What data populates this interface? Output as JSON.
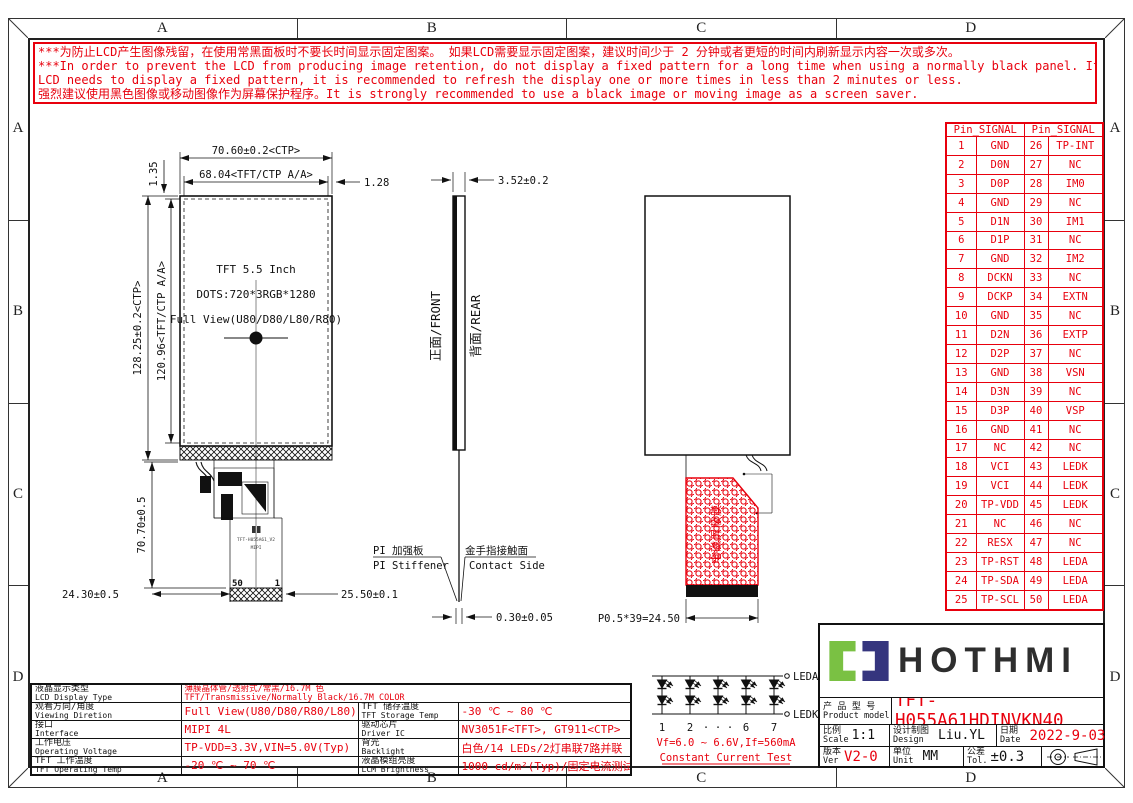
{
  "colors": {
    "red": "#e8000d",
    "logo_green": "#7ac143",
    "logo_navy": "#35357e"
  },
  "border": {
    "zones": [
      "A",
      "B",
      "C",
      "D"
    ]
  },
  "warning": {
    "lines": [
      "***为防止LCD产生图像残留，在使用常黑面板时不要长时间显示固定图案。 如果LCD需要显示固定图案，建议时间少于 2 分钟或者更短的时间内刷新显示内容一次或多次。",
      "***In order to prevent the LCD from producing image retention, do not display a fixed pattern for a long time when using a normally black panel. If the",
      " LCD needs to display a fixed pattern, it is recommended to refresh the display one or more times in less than 2 minutes or less.",
      "强烈建议使用黑色图像或移动图像作为屏幕保护程序。It is strongly recommended to use a black image or moving image as a screen saver."
    ]
  },
  "front_view": {
    "dim_width_ctp": "70.60±0.2<CTP>",
    "dim_width_aa": "68.04<TFT/CTP A/A>",
    "dim_edge_right": "1.28",
    "dim_edge_top": "1.35",
    "dim_height_ctp": "128.25±0.2<CTP>",
    "dim_height_aa": "120.96<TFT/CTP A/A>",
    "panel_line1": "TFT 5.5 Inch",
    "panel_line2": "DOTS:720*3RGB*1280",
    "panel_line3": "Full View(U80/D80/L80/R80)",
    "dim_fpc_length": "70.70±0.5",
    "dim_bottom_left": "24.30±0.5",
    "dim_connector": "25.50±0.1",
    "pin_label_50": "50",
    "pin_label_1": "1",
    "fpc_text_model": "TFT-H055A61_V2",
    "fpc_text_mipi": "MIPI"
  },
  "side_view": {
    "dim_thickness": "3.52±0.2",
    "label_front": "正面/FRONT",
    "label_rear": "背面/REAR",
    "stiffener_cn": "PI 加强板",
    "stiffener_en": "PI Stiffener",
    "contact_cn": "金手指接触面",
    "contact_en": "Contact Side",
    "dim_fpc_thickness": "0.30±0.05"
  },
  "rear_view": {
    "shield_film_label": "电磁屏蔽膜",
    "dim_pin_pitch": "P0.5*39=24.50"
  },
  "pin_table": {
    "header_left": "Pin_SIGNAL",
    "header_right": "Pin_SIGNAL",
    "rows": [
      [
        "1",
        "GND",
        "26",
        "TP-INT"
      ],
      [
        "2",
        "D0N",
        "27",
        "NC"
      ],
      [
        "3",
        "D0P",
        "28",
        "IM0"
      ],
      [
        "4",
        "GND",
        "29",
        "NC"
      ],
      [
        "5",
        "D1N",
        "30",
        "IM1"
      ],
      [
        "6",
        "D1P",
        "31",
        "NC"
      ],
      [
        "7",
        "GND",
        "32",
        "IM2"
      ],
      [
        "8",
        "DCKN",
        "33",
        "NC"
      ],
      [
        "9",
        "DCKP",
        "34",
        "EXTN"
      ],
      [
        "10",
        "GND",
        "35",
        "NC"
      ],
      [
        "11",
        "D2N",
        "36",
        "EXTP"
      ],
      [
        "12",
        "D2P",
        "37",
        "NC"
      ],
      [
        "13",
        "GND",
        "38",
        "VSN"
      ],
      [
        "14",
        "D3N",
        "39",
        "NC"
      ],
      [
        "15",
        "D3P",
        "40",
        "VSP"
      ],
      [
        "16",
        "GND",
        "41",
        "NC"
      ],
      [
        "17",
        "NC",
        "42",
        "NC"
      ],
      [
        "18",
        "VCI",
        "43",
        "LEDK"
      ],
      [
        "19",
        "VCI",
        "44",
        "LEDK"
      ],
      [
        "20",
        "TP-VDD",
        "45",
        "LEDK"
      ],
      [
        "21",
        "NC",
        "46",
        "NC"
      ],
      [
        "22",
        "RESX",
        "47",
        "NC"
      ],
      [
        "23",
        "TP-RST",
        "48",
        "LEDA"
      ],
      [
        "24",
        "TP-SDA",
        "49",
        "LEDA"
      ],
      [
        "25",
        "TP-SCL",
        "50",
        "LEDA"
      ]
    ]
  },
  "spec_table": {
    "row1": {
      "label_cn": "液晶显示类型",
      "label_en": "LCD Display Type",
      "value_cn": "薄膜晶体管/透射式/常黑/16.7M 色",
      "value_en": "TFT/Transmissive/Normally Black/16.7M COLOR"
    },
    "rows": [
      {
        "l_cn": "观看方向/角度",
        "l_en": "Viewing Diretion",
        "l_val": "Full View(U80/D80/R80/L80)",
        "r_cn": "TFT 储存温度",
        "r_en": "TFT Storage Temp",
        "r_val": "-30 ℃ ~ 80 ℃"
      },
      {
        "l_cn": "接口",
        "l_en": "Interface",
        "l_val": "MIPI 4L",
        "r_cn": "驱动芯片",
        "r_en": "Driver IC",
        "r_val": "NV3051F<TFT>, GT911<CTP>"
      },
      {
        "l_cn": "工作电压",
        "l_en": "Operating Voltage",
        "l_val": "TP-VDD=3.3V,VIN=5.0V(Typ)",
        "r_cn": "背光",
        "r_en": "Backlight",
        "r_val": "白色/14 LEDs/2灯串联7路并联"
      },
      {
        "l_cn": "TFT 工作温度",
        "l_en": "TFT Operating Temp",
        "l_val": "-20 ℃ ~ 70 ℃",
        "r_cn": "液晶模组亮度",
        "r_en": "LCM Brightness",
        "r_val": "1000 cd/m²(Typ)/固定电流测试"
      }
    ]
  },
  "led_circuit": {
    "terminal_top": "LEDA",
    "terminal_bottom": "LEDK",
    "branch_labels": [
      "1",
      "2",
      "·",
      "·",
      "·",
      "6",
      "7"
    ],
    "spec_line": "Vf=6.0 ~ 6.6V,If=560mA",
    "test_line": "Constant Current Test"
  },
  "title_block": {
    "logo_text": "HOTHMI",
    "product_label_cn": "产 品 型 号",
    "product_label_en": "Product model",
    "product_model": "TFT-H055A61HDINVKN40",
    "scale_cn": "比例",
    "scale_en": "Scale",
    "scale_value": "1:1",
    "design_cn": "设计制图",
    "design_en": "Design",
    "design_value": "Liu.YL",
    "date_cn": "日期",
    "date_en": "Date",
    "date_value": "2022-9-03",
    "ver_cn": "版本",
    "ver_en": "Ver",
    "ver_value": "V2-0",
    "unit_cn": "单位",
    "unit_en": "Unit",
    "unit_value": "MM",
    "tol_cn": "公差",
    "tol_en": "Tol.",
    "tol_value": "±0.3"
  }
}
